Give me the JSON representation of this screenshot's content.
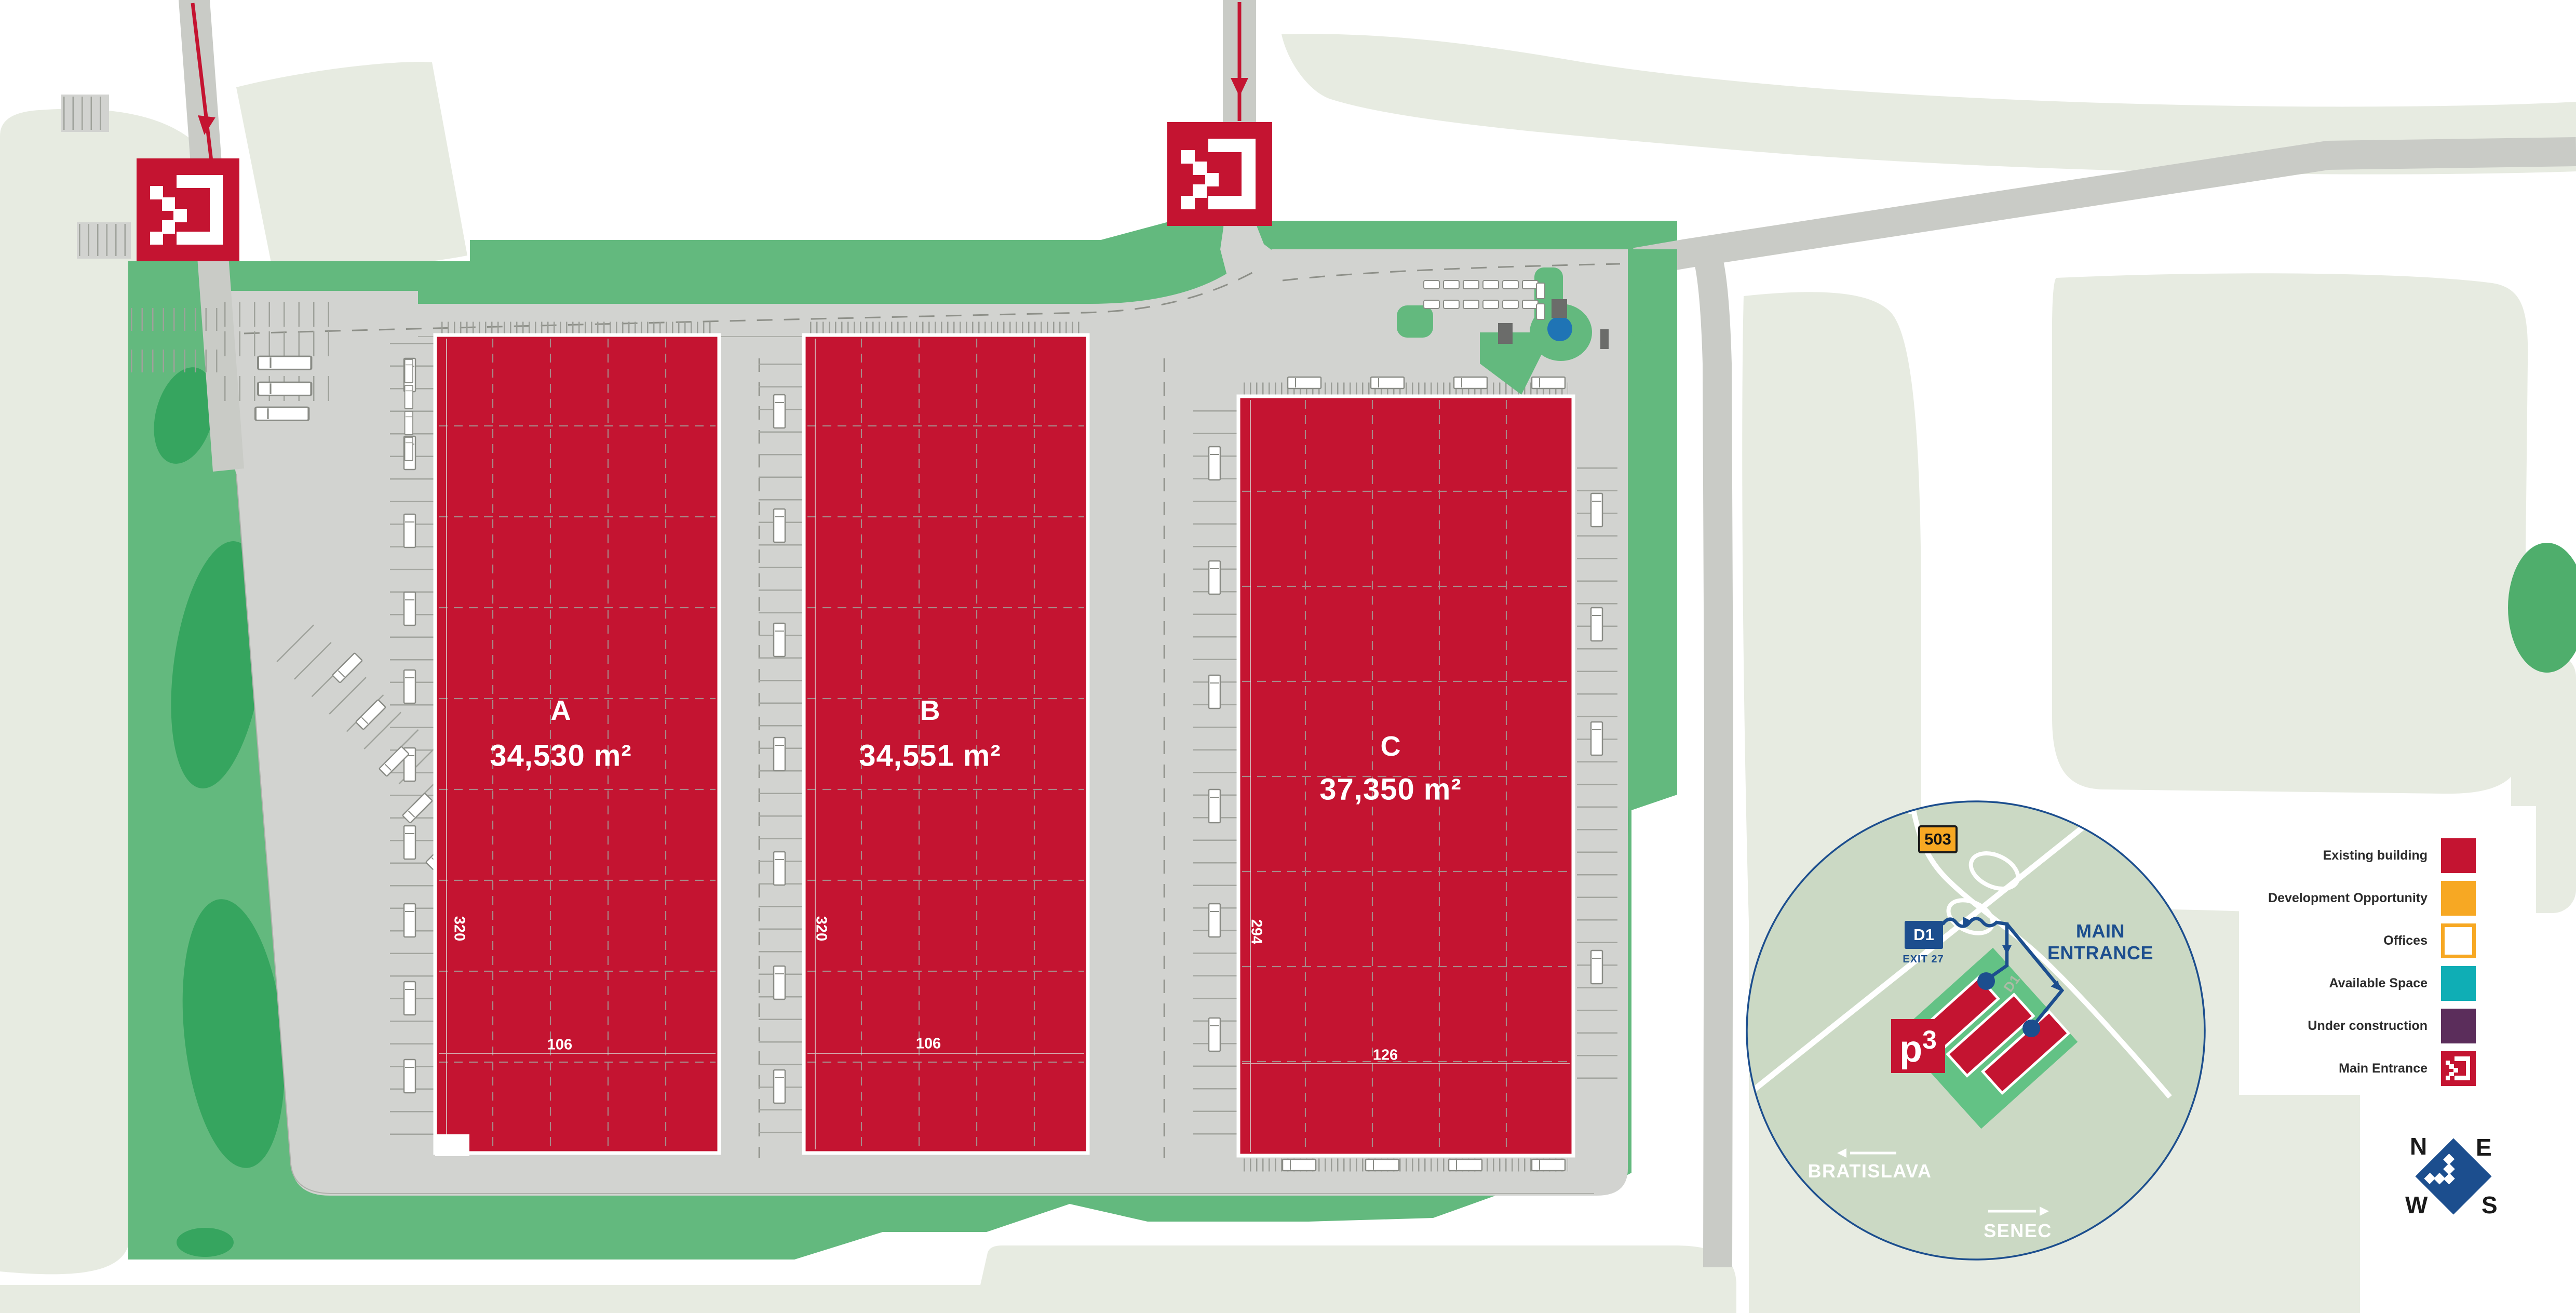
{
  "site": {
    "buildings": [
      {
        "id": "A",
        "letter": "A",
        "area": "34,530 m²",
        "dim_long": "320",
        "dim_short": "106"
      },
      {
        "id": "B",
        "letter": "B",
        "area": "34,551 m²",
        "dim_long": "320",
        "dim_short": "106"
      },
      {
        "id": "C",
        "letter": "C",
        "area": "37,350 m²",
        "dim_long": "294",
        "dim_short": "126"
      }
    ]
  },
  "legend": {
    "items": [
      {
        "label": "Existing building",
        "color": "#C41431"
      },
      {
        "label": "Development Opportunity",
        "color": "#F7A823"
      },
      {
        "label": "Offices",
        "color": "#FFFFFF",
        "border": "#F7A823"
      },
      {
        "label": "Available Space",
        "color": "#0FAEB5"
      },
      {
        "label": "Under construction",
        "color": "#5B2D5B"
      },
      {
        "label": "Main Entrance",
        "color": "#C41431"
      }
    ]
  },
  "inset": {
    "shield_503": "503",
    "shield_d1": "D1",
    "exit_label": "EXIT 27",
    "main_entrance": "MAIN ENTRANCE",
    "city_west": "BRATISLAVA",
    "city_east": "SENEC",
    "logo_p": "p",
    "logo_3": "3",
    "road_watermark": "D1"
  },
  "compass": {
    "n": "N",
    "e": "E",
    "w": "W",
    "s": "S"
  },
  "colors": {
    "existing_building": "#C41431",
    "development_opportunity": "#F7A823",
    "available_space": "#0FAEB5",
    "under_construction": "#5B2D5B",
    "park_green": "#63B97E",
    "dark_green": "#36A55F",
    "field_pale": "#E7EBE1",
    "paving": "#D2D3D0",
    "road": "#C9CBC6",
    "inset_blue": "#1C4E8E",
    "inset_fill": "#CBD9C4",
    "pond_blue": "#1F74B5"
  }
}
